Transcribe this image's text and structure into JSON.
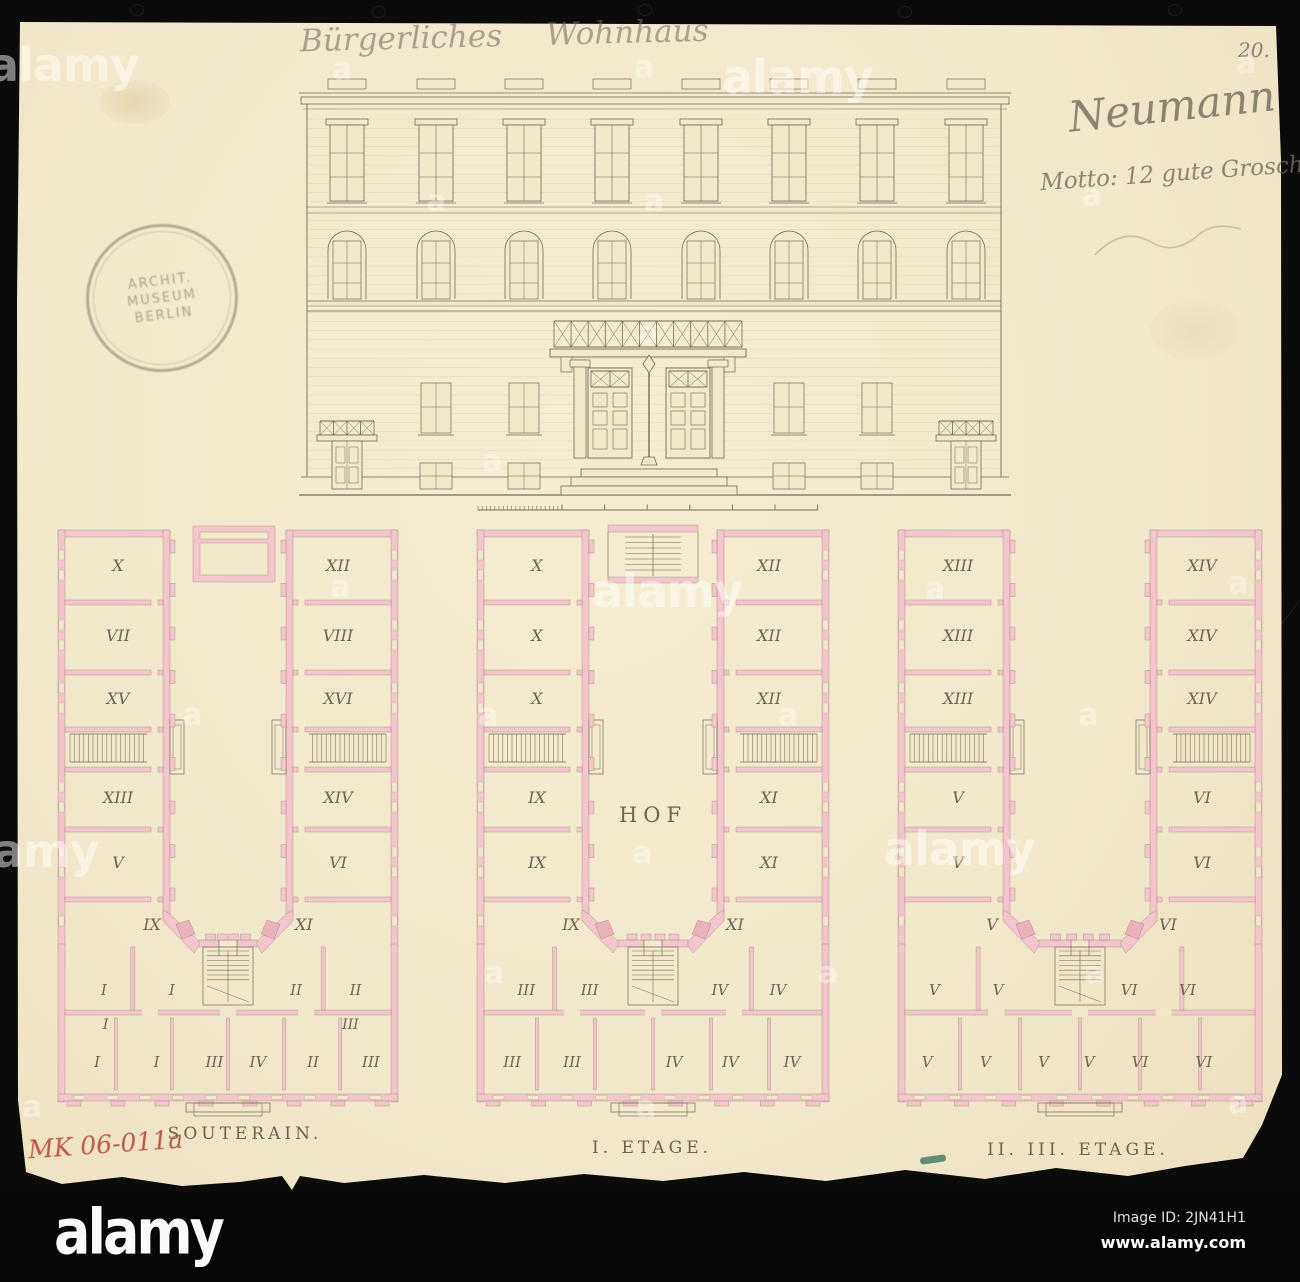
{
  "annotations": {
    "header_title": "Bürgerliches Wohnhaus",
    "page_number": "20.",
    "signature": "Neumann",
    "motto": "Motto: 12 gute Groschen",
    "inventory_number": "MK 06-011a"
  },
  "stamp": {
    "lines": [
      "ARCHIT.",
      "MUSEUM",
      "BERLIN"
    ]
  },
  "plans": [
    {
      "caption": "SOUTERAIN.",
      "left_wing": [
        "X",
        "VII",
        "XV",
        "XIII",
        "V",
        "IX"
      ],
      "right_wing": [
        "XII",
        "VIII",
        "XVI",
        "XIV",
        "VI",
        "XI"
      ],
      "bottom_upper": [
        "I",
        "I",
        "II",
        "II"
      ],
      "bottom_mid": [
        "I",
        "III"
      ],
      "bottom_lower": [
        "I",
        "I",
        "III",
        "IV",
        "II",
        "III"
      ],
      "courtyard_label": ""
    },
    {
      "caption": "I. ETAGE.",
      "left_wing": [
        "X",
        "X",
        "X",
        "IX",
        "IX",
        "IX"
      ],
      "right_wing": [
        "XII",
        "XII",
        "XII",
        "XI",
        "XI",
        "XI"
      ],
      "bottom_upper": [
        "III",
        "III",
        "IV",
        "IV"
      ],
      "bottom_mid": [],
      "bottom_lower": [
        "III",
        "III",
        "IV",
        "IV",
        "IV"
      ],
      "courtyard_label": "HOF"
    },
    {
      "caption": "II. III. ETAGE.",
      "left_wing": [
        "XIII",
        "XIII",
        "XIII",
        "V",
        "V",
        "V"
      ],
      "right_wing": [
        "XIV",
        "XIV",
        "XIV",
        "VI",
        "VI",
        "VI"
      ],
      "bottom_upper": [
        "V",
        "V",
        "VI",
        "VI"
      ],
      "bottom_mid": [],
      "bottom_lower": [
        "V",
        "V",
        "V",
        "V",
        "VI",
        "VI"
      ],
      "courtyard_label": ""
    }
  ],
  "watermark": {
    "word": "alamy",
    "letter": "a"
  },
  "footer": {
    "logo": "alamy",
    "image_id": "Image ID: 2JN41H1",
    "website": "www.alamy.com"
  },
  "colors": {
    "paper": "#f2e8cc",
    "wall_pink": "#f3c6cd",
    "wall_pink_dark": "#eab2bc",
    "ink": "#756a5b",
    "pencil": "#8a8377",
    "red_ink": "#bf4a38",
    "black": "#0a0a0a"
  }
}
